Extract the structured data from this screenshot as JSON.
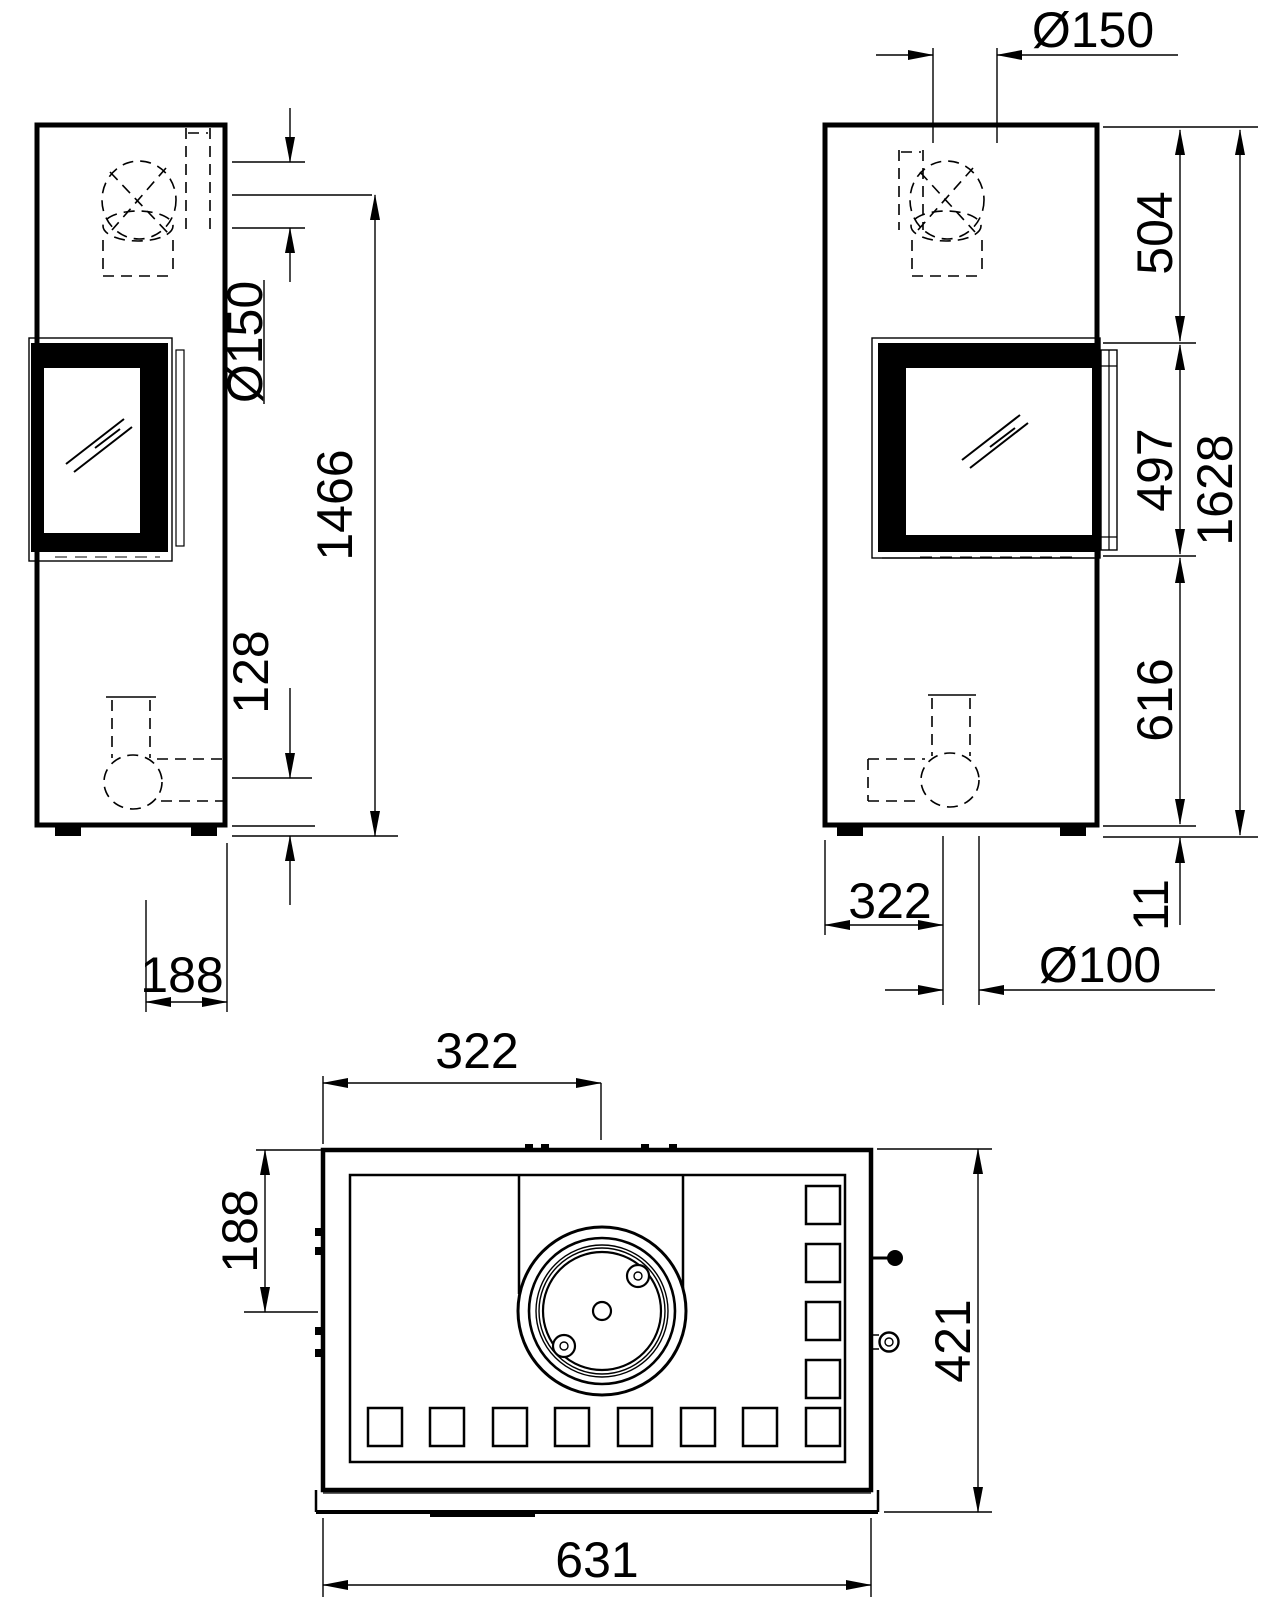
{
  "drawing_type": "stove dimensional drawing",
  "views": {
    "side": {
      "dims": {
        "flue_diameter": "Ø150",
        "flue_center_height": "1466",
        "air_inlet_center_height": "128",
        "rear_base_depth": "188"
      }
    },
    "front": {
      "dims": {
        "flue_diameter": "Ø150",
        "top_to_window": "504",
        "window_height": "497",
        "total_height": "1628",
        "window_to_floor": "616",
        "foot_height": "11",
        "flue_offset_from_left": "322",
        "air_inlet_diameter": "Ø100"
      }
    },
    "top": {
      "dims": {
        "flue_center_offset": "322",
        "flue_center_from_rear": "188",
        "body_depth": "421",
        "body_width": "631"
      }
    }
  },
  "colors": {
    "line": "#000000",
    "background": "#ffffff",
    "text": "#000000"
  }
}
